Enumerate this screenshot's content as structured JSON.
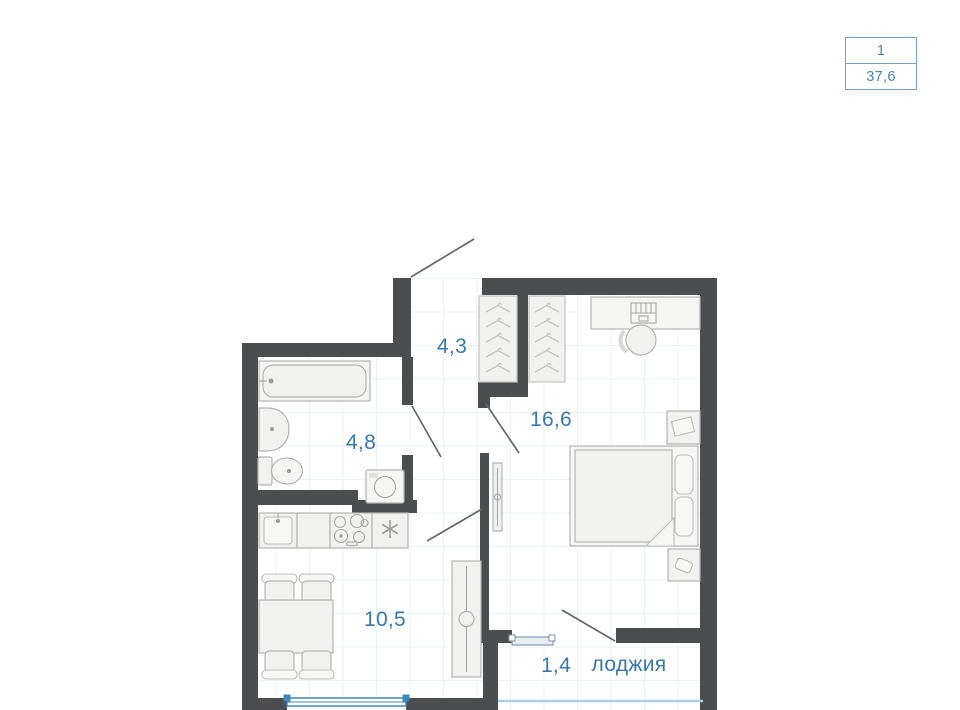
{
  "info_card": {
    "rooms_count": "1",
    "total_area": "37,6"
  },
  "plan": {
    "labels": {
      "hallway_area": "4,3",
      "bathroom_area": "4,8",
      "bedroom_area": "16,6",
      "kitchen_area": "10,5",
      "loggia_area": "1,4",
      "loggia_name": "лоджия"
    }
  },
  "colors": {
    "wall": "#4b4d4f",
    "label_text": "#3878ab",
    "card_border": "#71a2c6",
    "card_text": "#4a86b4",
    "window_blue": "#3f86bb",
    "loggia_window_gray": "#8699a9",
    "balcony_glazing": "#aecfe6",
    "furniture_line": "#b4b5b3",
    "furniture_fill": "#f1f1ef",
    "grid_line": "#ecf3f8"
  }
}
